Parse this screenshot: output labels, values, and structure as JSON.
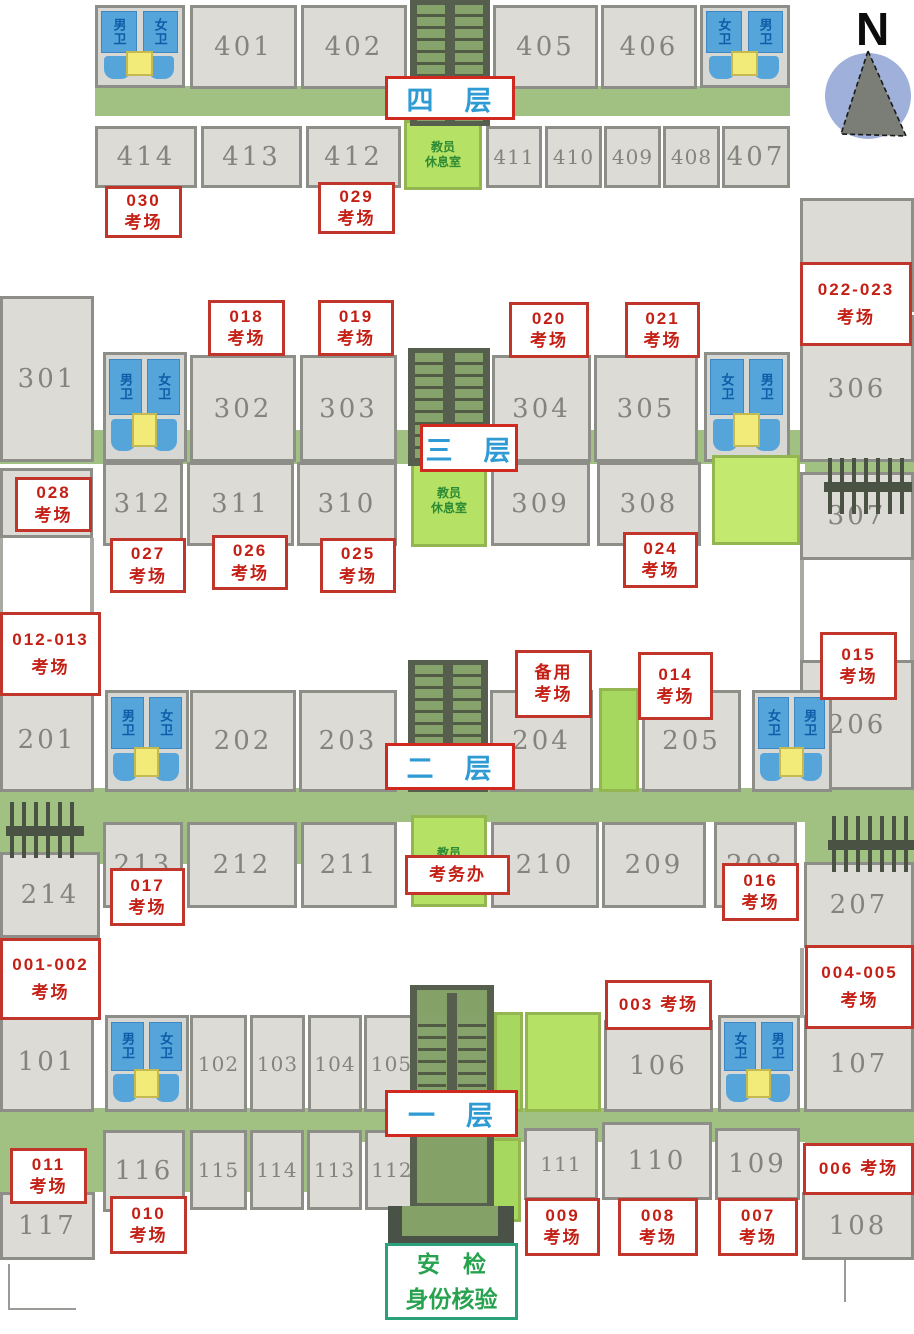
{
  "compass": {
    "label": "N"
  },
  "toilets": {
    "male": "男卫",
    "female": "女卫"
  },
  "green_rooms": {
    "teacher": "教员\n休息室"
  },
  "security": {
    "line1": "安　检",
    "line2": "身份核验"
  },
  "floors": {
    "f4": {
      "label": "四　层",
      "rooms": {
        "401": "401",
        "402": "402",
        "405": "405",
        "406": "406",
        "407": "407",
        "408": "408",
        "409": "409",
        "410": "410",
        "411": "411",
        "412": "412",
        "413": "413",
        "414": "414"
      }
    },
    "f3": {
      "label": "三　层",
      "rooms": {
        "301": "301",
        "302": "302",
        "303": "303",
        "304": "304",
        "305": "305",
        "306": "306",
        "307": "307",
        "308": "308",
        "309": "309",
        "310": "310",
        "311": "311",
        "312": "312",
        "313": "313"
      }
    },
    "f2": {
      "label": "二　层",
      "rooms": {
        "201": "201",
        "202": "202",
        "203": "203",
        "204": "204",
        "205": "205",
        "206": "206",
        "207": "207",
        "208": "208",
        "209": "209",
        "210": "210",
        "211": "211",
        "212": "212",
        "213": "213",
        "214": "214"
      }
    },
    "f1": {
      "label": "一　层",
      "rooms": {
        "101": "101",
        "102": "102",
        "103": "103",
        "104": "104",
        "105": "105",
        "106": "106",
        "107": "107",
        "108": "108",
        "109": "109",
        "110": "110",
        "111": "111",
        "112": "112",
        "113": "113",
        "114": "114",
        "115": "115",
        "116": "116",
        "117": "117"
      }
    }
  },
  "callouts": {
    "c030": {
      "num": "030",
      "word": "考场"
    },
    "c029": {
      "num": "029",
      "word": "考场"
    },
    "c018": {
      "num": "018",
      "word": "考场"
    },
    "c019": {
      "num": "019",
      "word": "考场"
    },
    "c020": {
      "num": "020",
      "word": "考场"
    },
    "c021": {
      "num": "021",
      "word": "考场"
    },
    "c022_023": {
      "num": "022-023",
      "word": "考场"
    },
    "c028": {
      "num": "028",
      "word": "考场"
    },
    "c027": {
      "num": "027",
      "word": "考场"
    },
    "c026": {
      "num": "026",
      "word": "考场"
    },
    "c025": {
      "num": "025",
      "word": "考场"
    },
    "c024": {
      "num": "024",
      "word": "考场"
    },
    "c012_013": {
      "num": "012-013",
      "word": "考场"
    },
    "backup": {
      "num": "备用",
      "word": "考场"
    },
    "c014": {
      "num": "014",
      "word": "考场"
    },
    "c015": {
      "num": "015",
      "word": "考场"
    },
    "c017": {
      "num": "017",
      "word": "考场"
    },
    "c016": {
      "num": "016",
      "word": "考场"
    },
    "exam_office": {
      "text": "考务办"
    },
    "c001_002": {
      "num": "001-002",
      "word": "考场"
    },
    "c003": {
      "num": "003",
      "word": "考场"
    },
    "c004_005": {
      "num": "004-005",
      "word": "考场"
    },
    "c011": {
      "num": "011",
      "word": "考场"
    },
    "c010": {
      "num": "010",
      "word": "考场"
    },
    "c009": {
      "num": "009",
      "word": "考场"
    },
    "c008": {
      "num": "008",
      "word": "考场"
    },
    "c007": {
      "num": "007",
      "word": "考场"
    },
    "c006": {
      "num": "006",
      "word": "考场"
    }
  }
}
